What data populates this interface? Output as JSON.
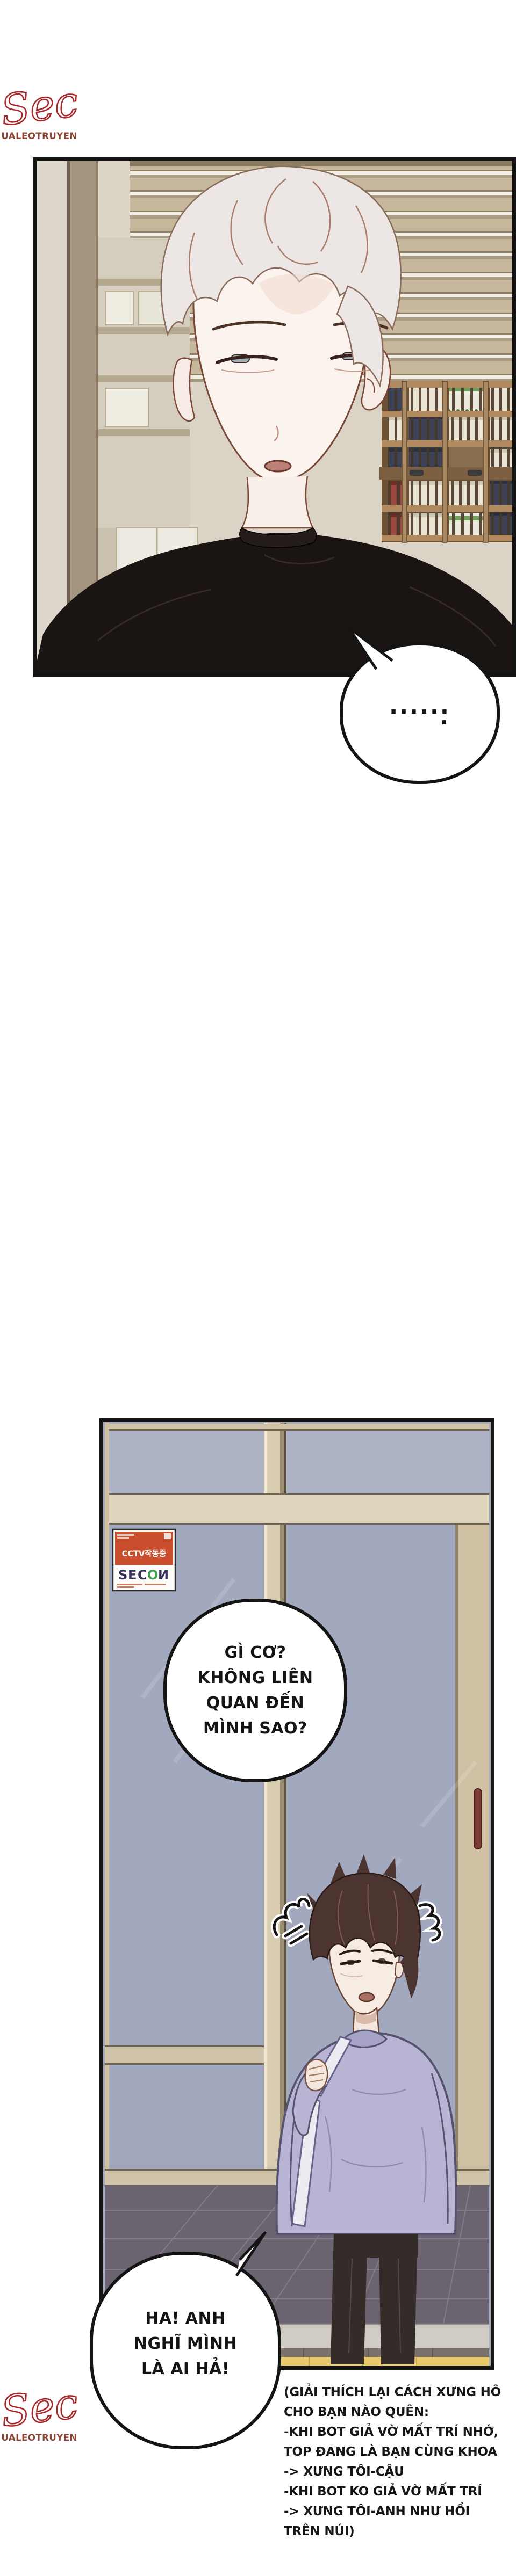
{
  "watermark": {
    "script": "Sec",
    "site": "DUALEOTRUYEN"
  },
  "panel1": {
    "bubble_dots": {
      "row": "......",
      "tail": "."
    }
  },
  "panel2": {
    "sticker": {
      "cctv": "CCTV작동중",
      "brand": [
        "S",
        "E",
        "C",
        "O",
        "И"
      ]
    },
    "bubble_question": {
      "lines": [
        "GÌ CƠ?",
        "KHÔNG LIÊN",
        "QUAN ĐẾN",
        "MÌNH SAO?"
      ]
    }
  },
  "bubble_exclaim": {
    "lines": [
      "HA! ANH",
      "NGHĨ MÌNH",
      "LÀ AI HẢ!"
    ]
  },
  "footnote": {
    "lines": [
      "(GIẢI THÍCH LẠI CÁCH XƯNG HÔ",
      "CHO BẠN NÀO QUÊN:",
      "-KHI BOT GIẢ VỜ MẤT TRÍ NHỚ,",
      "TOP ĐANG LÀ BẠN CÙNG KHOA",
      "-> XƯNG TÔI-CẬU",
      "-KHI BOT KO GIẢ VỜ MẤT TRÍ",
      "-> XƯNG TÔI-ANH NHƯ HỒI",
      "TRÊN NÚI)"
    ]
  },
  "colors": {
    "logo_red": "#a92728",
    "logo_brown": "#8d4331",
    "panel_border": "#141414",
    "sticker_orange": "#c84e2d",
    "brand_navy": "#32325a",
    "brand_green": "#3f9e4d",
    "glass_lavender": "#a2a8bd",
    "frame_beige": "#d8ccb1",
    "sweatshirt_lavender": "#b8b5d4",
    "shirt_black": "#1a1412",
    "tactile_yellow": "#e9ca6c"
  }
}
